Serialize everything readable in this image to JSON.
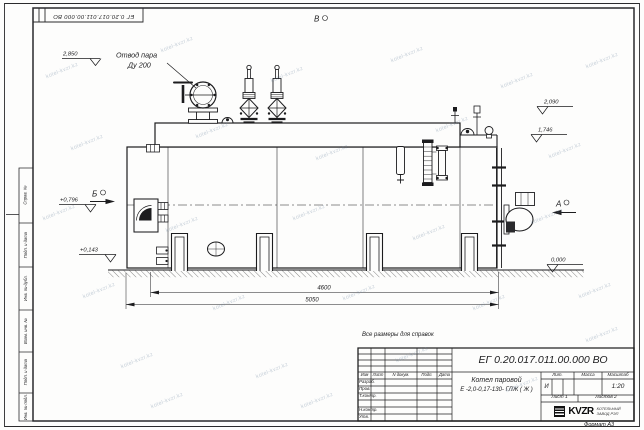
{
  "meta": {
    "top_stamp": "ЕГ 0.20.017.011.00.000  ВО",
    "format_label": "Формат А3",
    "reference_note": "Все размеры для справок"
  },
  "title_block": {
    "doc_number": "ЕГ 0.20.017.011.00.000  ВО",
    "product_name_line1": "Котел паровой",
    "product_name_line2": "Е -2,0-0,17-130- ГЛЖ ( Ж )",
    "col_headers": [
      "Изм",
      "Лист",
      "N докум.",
      "Подп.",
      "Дата"
    ],
    "sig_rows": [
      "Разраб.",
      "Пров.",
      "Т.контр.",
      "",
      "Н.контр.",
      "Утв."
    ],
    "lit_header": "Лит.",
    "mass_header": "Масса",
    "scale_header": "Масштаб",
    "lit_value": "И",
    "scale_value": "1:20",
    "sheet_label": "Лист 1",
    "sheets_label": "Листов 2",
    "company_logo": "KVZR",
    "company_line1": "КОТЕЛЬНЫЙ",
    "company_line2": "ЗАВОД РЭП"
  },
  "margin_labels": [
    "Справ. №",
    "Подп. и дата",
    "Инв. № дубл.",
    "Взам. инв. №",
    "Подп. и дата",
    "Инв. № подл."
  ],
  "drawing": {
    "callout_line1": "Отвод пара",
    "callout_line2": "Ду 200",
    "view_markers": {
      "top": "В",
      "left": "Б",
      "right": "А"
    },
    "elevations": {
      "steam": "2,850",
      "right_upper": "2,090",
      "right_lower": "1,746",
      "left_upper": "+0,796",
      "left_lower": "+0,143",
      "ground": "0,000"
    },
    "dimensions": {
      "inner": "4600",
      "overall": "5050"
    }
  },
  "watermark": {
    "text": "kotel-kvzr.kz"
  },
  "colors": {
    "line": "#1c1c1e",
    "watermark": "#6e87a0"
  }
}
